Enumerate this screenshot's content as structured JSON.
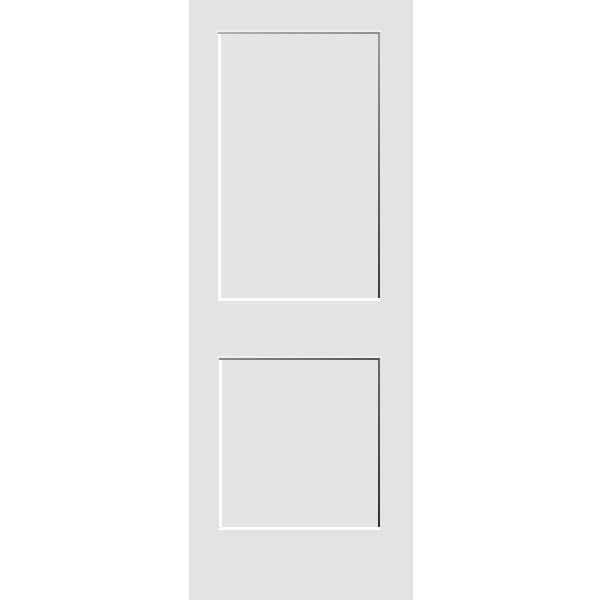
{
  "image": {
    "kind": "product-photo",
    "subject": "two-panel shaker interior door",
    "panel_count": 2,
    "background_color": "#ffffff"
  },
  "door": {
    "face_color": "#e3e3e3",
    "panel_interior_color": "#e4e4e4",
    "highlight_color": "#fcfcfc",
    "soft_highlight_color": "#f0f0f0",
    "panels": [
      {
        "name": "top-panel",
        "top_shadow_left": "#b0b0b0",
        "top_shadow_right": "#8f8f8f",
        "right_shadow_top": "#9a9a9a",
        "right_shadow_bottom": "#3c3c3c"
      },
      {
        "name": "bottom-panel",
        "top_shadow_left": "#8a8a8a",
        "top_shadow_right": "#565656",
        "right_shadow_top": "#6a6a6a",
        "right_shadow_bottom": "#303030"
      }
    ]
  }
}
